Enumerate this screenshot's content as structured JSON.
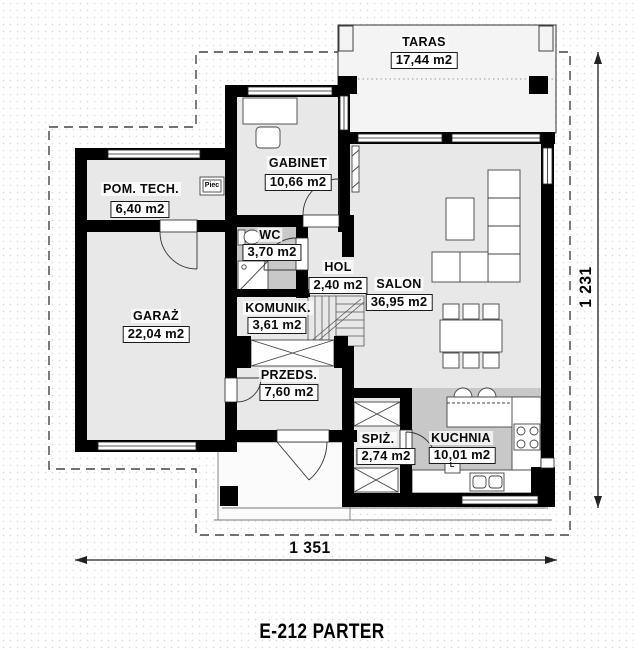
{
  "title": "E-212 PARTER",
  "dimensions": {
    "bottom": "1 351",
    "right": "1 231"
  },
  "rooms": {
    "taras": {
      "name": "TARAS",
      "area": "17,44 m2"
    },
    "pom_tech": {
      "name": "POM. TECH.",
      "area": "6,40 m2"
    },
    "gabinet": {
      "name": "GABINET",
      "area": "10,66 m2"
    },
    "wc": {
      "name": "WC",
      "area": "3,70 m2"
    },
    "hol": {
      "name": "HOL",
      "area": "2,40 m2"
    },
    "salon": {
      "name": "SALON",
      "area": "36,95 m2"
    },
    "garaz": {
      "name": "GARAŻ",
      "area": "22,04 m2"
    },
    "komunik": {
      "name": "KOMUNIK.",
      "area": "3,61 m2"
    },
    "przeds": {
      "name": "PRZEDS.",
      "area": "7,60 m2"
    },
    "spiz": {
      "name": "SPIŻ.",
      "area": "2,74 m2"
    },
    "kuchnia": {
      "name": "KUCHNIA",
      "area": "10,01 m2"
    }
  },
  "annotations": {
    "furnace": "Piec",
    "fridge": "L"
  },
  "colors": {
    "wall": "#000000",
    "floor": "#e8e8e8",
    "shaded_floor": "#c8c8c8"
  }
}
